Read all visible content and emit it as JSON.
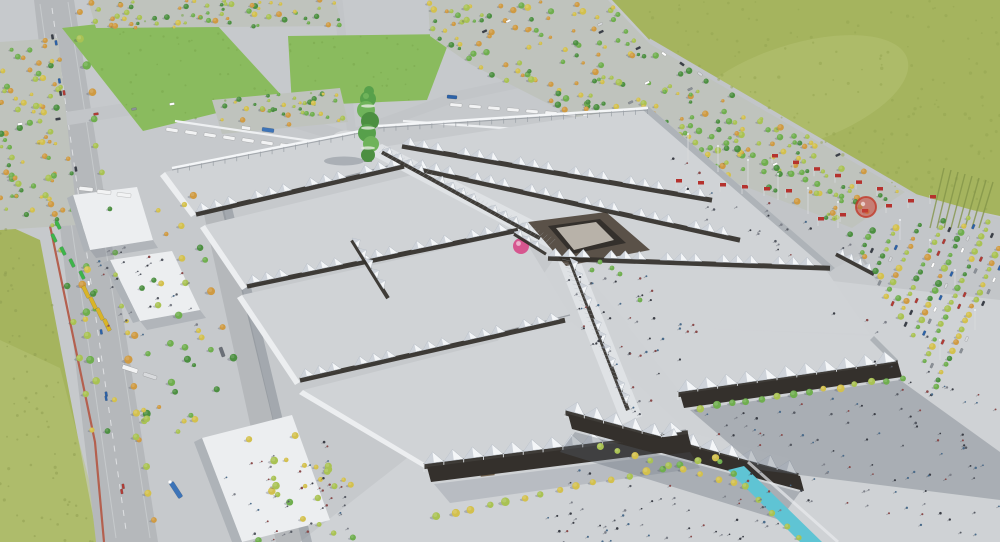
{
  "meta": {
    "description": "Aerial architectural rendering of a large exhibition fairground masterplan: rows of grey exhibition halls joined by white tensile canopy walkways arranged in a chevron around a central node with a pink spherical pavilion, a green vertical-garden tower at the north spine, bus terminals and lawns to the north-west, tree-planted parking lots and an entrance esplanade with red flags to the east, a motorway on the west edge and open green fields around the site.",
    "width": 1000,
    "height": 542
  },
  "palette": {
    "ground": "#c6c9cc",
    "ground2": "#c3c6c9",
    "road": "#b5b8bb",
    "road_light": "#c2c5c8",
    "field": "#a5b45e",
    "field_light": "#b7c378",
    "lawn": "#8abb5e",
    "hall_roof": "#d0d3d6",
    "canopy_white": "#f4f6f8",
    "canopy_shade": "#c7cdd5",
    "canopy_dark_gap": "#33302b",
    "facade_dark": "#34302c",
    "wall_light": "#eceef0",
    "wall_side": "#aeb3b8",
    "edge_shadow": "#8e939a",
    "plaza": "#cfd2d5",
    "axis_walk": "#dfe2e5",
    "shadow": "rgba(90,98,112,0.32)",
    "water": "#5fc4d4",
    "tower_green": "#57a04b",
    "tree_green": "#6fae4e",
    "tree_lime": "#a9c253",
    "tree_yellow": "#d3c04d",
    "tree_orange": "#cf9a42",
    "flag_red": "#b5322e",
    "sign_red": "#cc4538",
    "accent_pink": "#d6568f",
    "bus_white": "#f2f3f4",
    "bus_blue": "#2c62a8",
    "truck_blue": "#3d74b8",
    "bus_yellow": "#d9b428",
    "vehicle_green": "#3db54a",
    "bike_path": "#b4604f",
    "node_brown": "#5a5148",
    "node_roof": "#b8b2a9",
    "people": "#3a3d45",
    "shelter": "#eef0f2"
  },
  "scene": {
    "landmarks": [
      {
        "name": "green-vertical-garden-tower"
      },
      {
        "name": "central-node-building"
      },
      {
        "name": "pink-sphere-pavilion"
      },
      {
        "name": "exhibition-hall-west-wing"
      },
      {
        "name": "exhibition-hall-east-wing"
      },
      {
        "name": "front-halls-dark-facade"
      },
      {
        "name": "canopy-walkway-spines"
      },
      {
        "name": "north-bus-terminal"
      },
      {
        "name": "east-entrance-esplanade-flags"
      },
      {
        "name": "tree-planted-parking"
      },
      {
        "name": "lawns-northwest"
      },
      {
        "name": "motorway-west"
      },
      {
        "name": "fields-northeast"
      },
      {
        "name": "south-plaza-with-visitors"
      },
      {
        "name": "water-feature"
      }
    ]
  }
}
